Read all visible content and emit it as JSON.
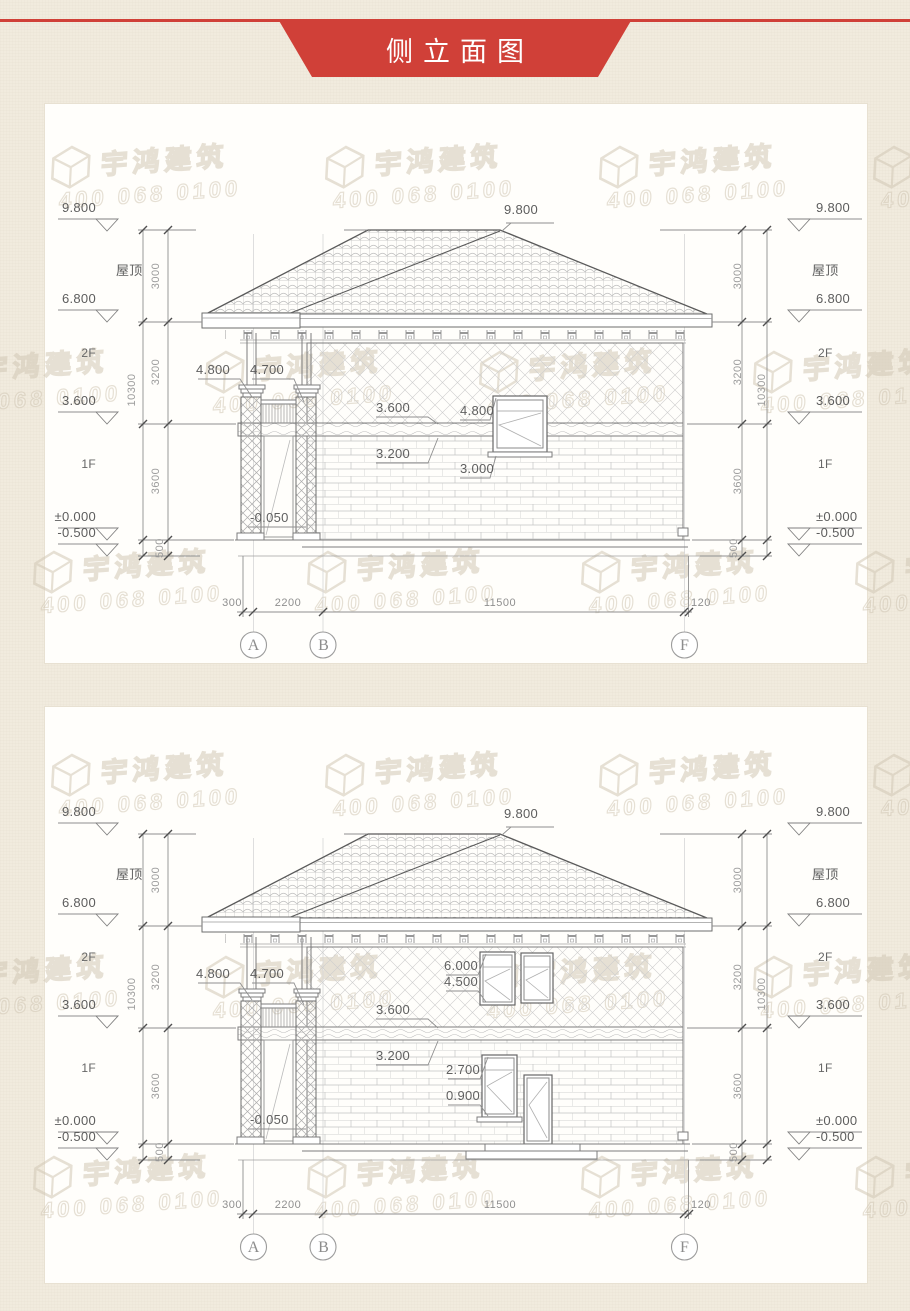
{
  "page": {
    "banner_title": "侧立面图"
  },
  "watermark": {
    "brand": "宇鸿建筑",
    "phone": "400 068 0100"
  },
  "levels": {
    "peak": "9.800",
    "roof": "屋顶",
    "eave": "6.800",
    "f2": "2F",
    "mid": "3.600",
    "f1": "1F",
    "zero": "±0.000",
    "ground": "-0.500"
  },
  "vdims": {
    "roof": "3000",
    "f2": "3200",
    "f1": "3600",
    "plinth": "500",
    "total": "10300"
  },
  "hdims": {
    "left": "300",
    "porch": "2200",
    "main": "11500",
    "right": "120"
  },
  "axes": {
    "a": "A",
    "b": "B",
    "f": "F"
  },
  "drawing1": {
    "annotations": {
      "porch_top": "4.800",
      "beam": "4.700",
      "level2": "3.600",
      "slab": "3.200",
      "window_top": "4.800",
      "window_sill": "3.000",
      "porch_floor": "-0.050"
    }
  },
  "drawing2": {
    "annotations": {
      "porch_top": "4.800",
      "beam": "4.700",
      "level2": "3.600",
      "slab": "3.200",
      "window2f_top": "6.000",
      "window2f_sill": "4.500",
      "window1f_top": "2.700",
      "window1f_sill": "0.900",
      "porch_floor": "-0.050"
    }
  }
}
